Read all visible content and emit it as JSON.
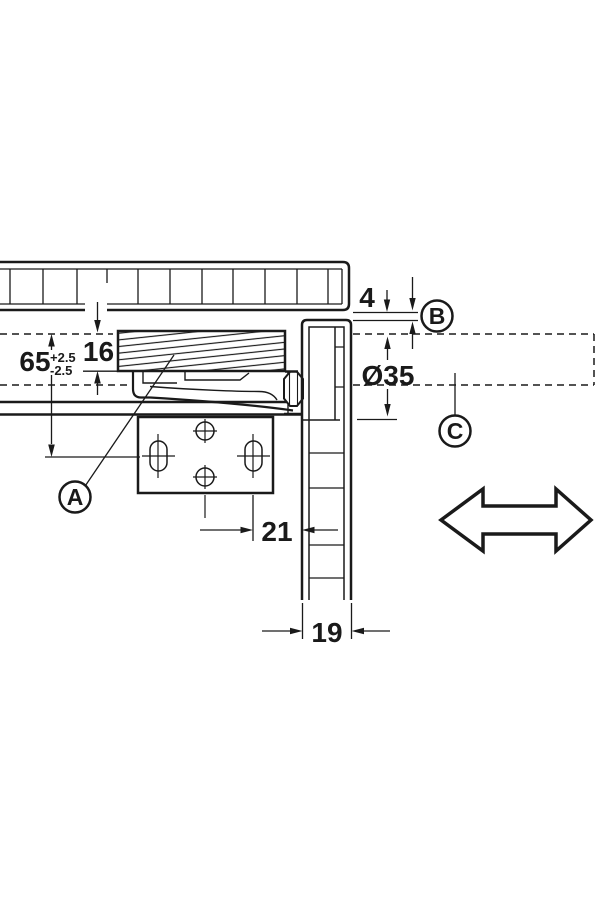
{
  "page": {
    "background": "#ffffff",
    "ink": "#1a1a1a"
  },
  "drawing": {
    "kind": "hinge-mounting-cross-section",
    "dims": {
      "d65": "65",
      "d65_tol_plus": "+2.5",
      "d65_tol_minus": "-2.5",
      "d16": "16",
      "d4": "4",
      "d35": "Ø35",
      "d21": "21",
      "d19": "19"
    },
    "callouts": {
      "a": "A",
      "b": "B",
      "c": "C"
    },
    "symbols": [
      {
        "name": "double-headed-arrow"
      }
    ]
  }
}
